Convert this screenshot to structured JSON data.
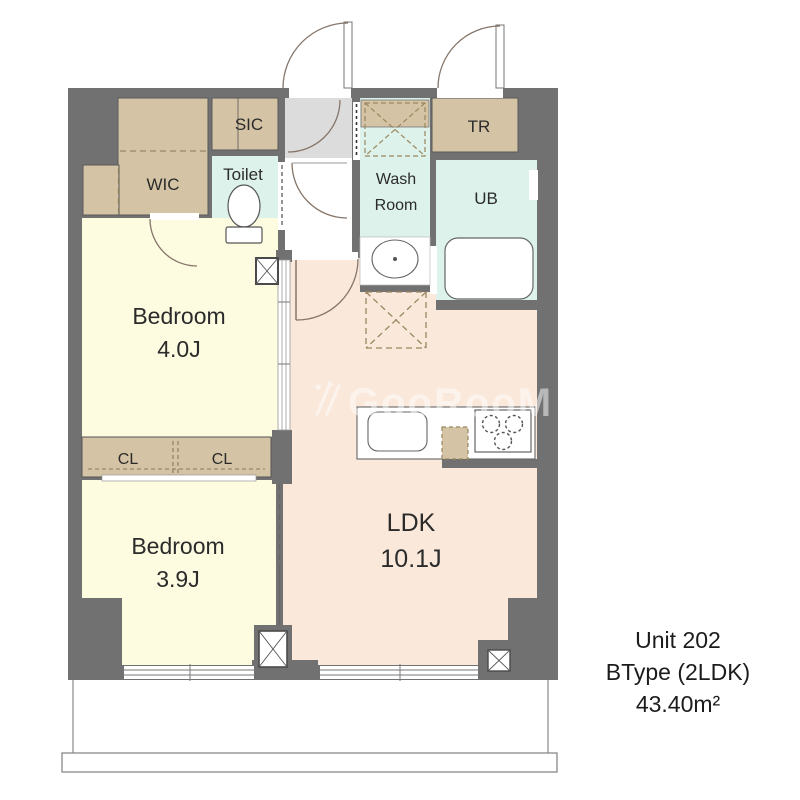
{
  "unit_info": {
    "unit": "Unit 202",
    "type": "BType (2LDK)",
    "area": "43.40m²"
  },
  "watermark": {
    "text": "GooRooM",
    "icon": "chopsticks-logo-icon"
  },
  "rooms": {
    "wic": {
      "label": "WIC"
    },
    "sic": {
      "label": "SIC"
    },
    "toilet": {
      "label": "Toilet"
    },
    "wash_room": {
      "label_line1": "Wash",
      "label_line2": "Room"
    },
    "tr": {
      "label": "TR"
    },
    "ub": {
      "label": "UB"
    },
    "bedroom1": {
      "label": "Bedroom",
      "size": "4.0J"
    },
    "bedroom2": {
      "label": "Bedroom",
      "size": "3.9J"
    },
    "cl_left": {
      "label": "CL"
    },
    "cl_right": {
      "label": "CL"
    },
    "ldk": {
      "label": "LDK",
      "size": "10.1J"
    }
  },
  "colors": {
    "wall": "#717171",
    "storage_tan": "#d4c3a4",
    "wet_area_cyan": "#dcf2ea",
    "bedroom_yellow": "#fdfbe0",
    "ldk_pink": "#fae8da",
    "entrance_gray": "#dcdcdc",
    "dash_brown": "#9a875f",
    "watermark_white": "#ffffff"
  }
}
